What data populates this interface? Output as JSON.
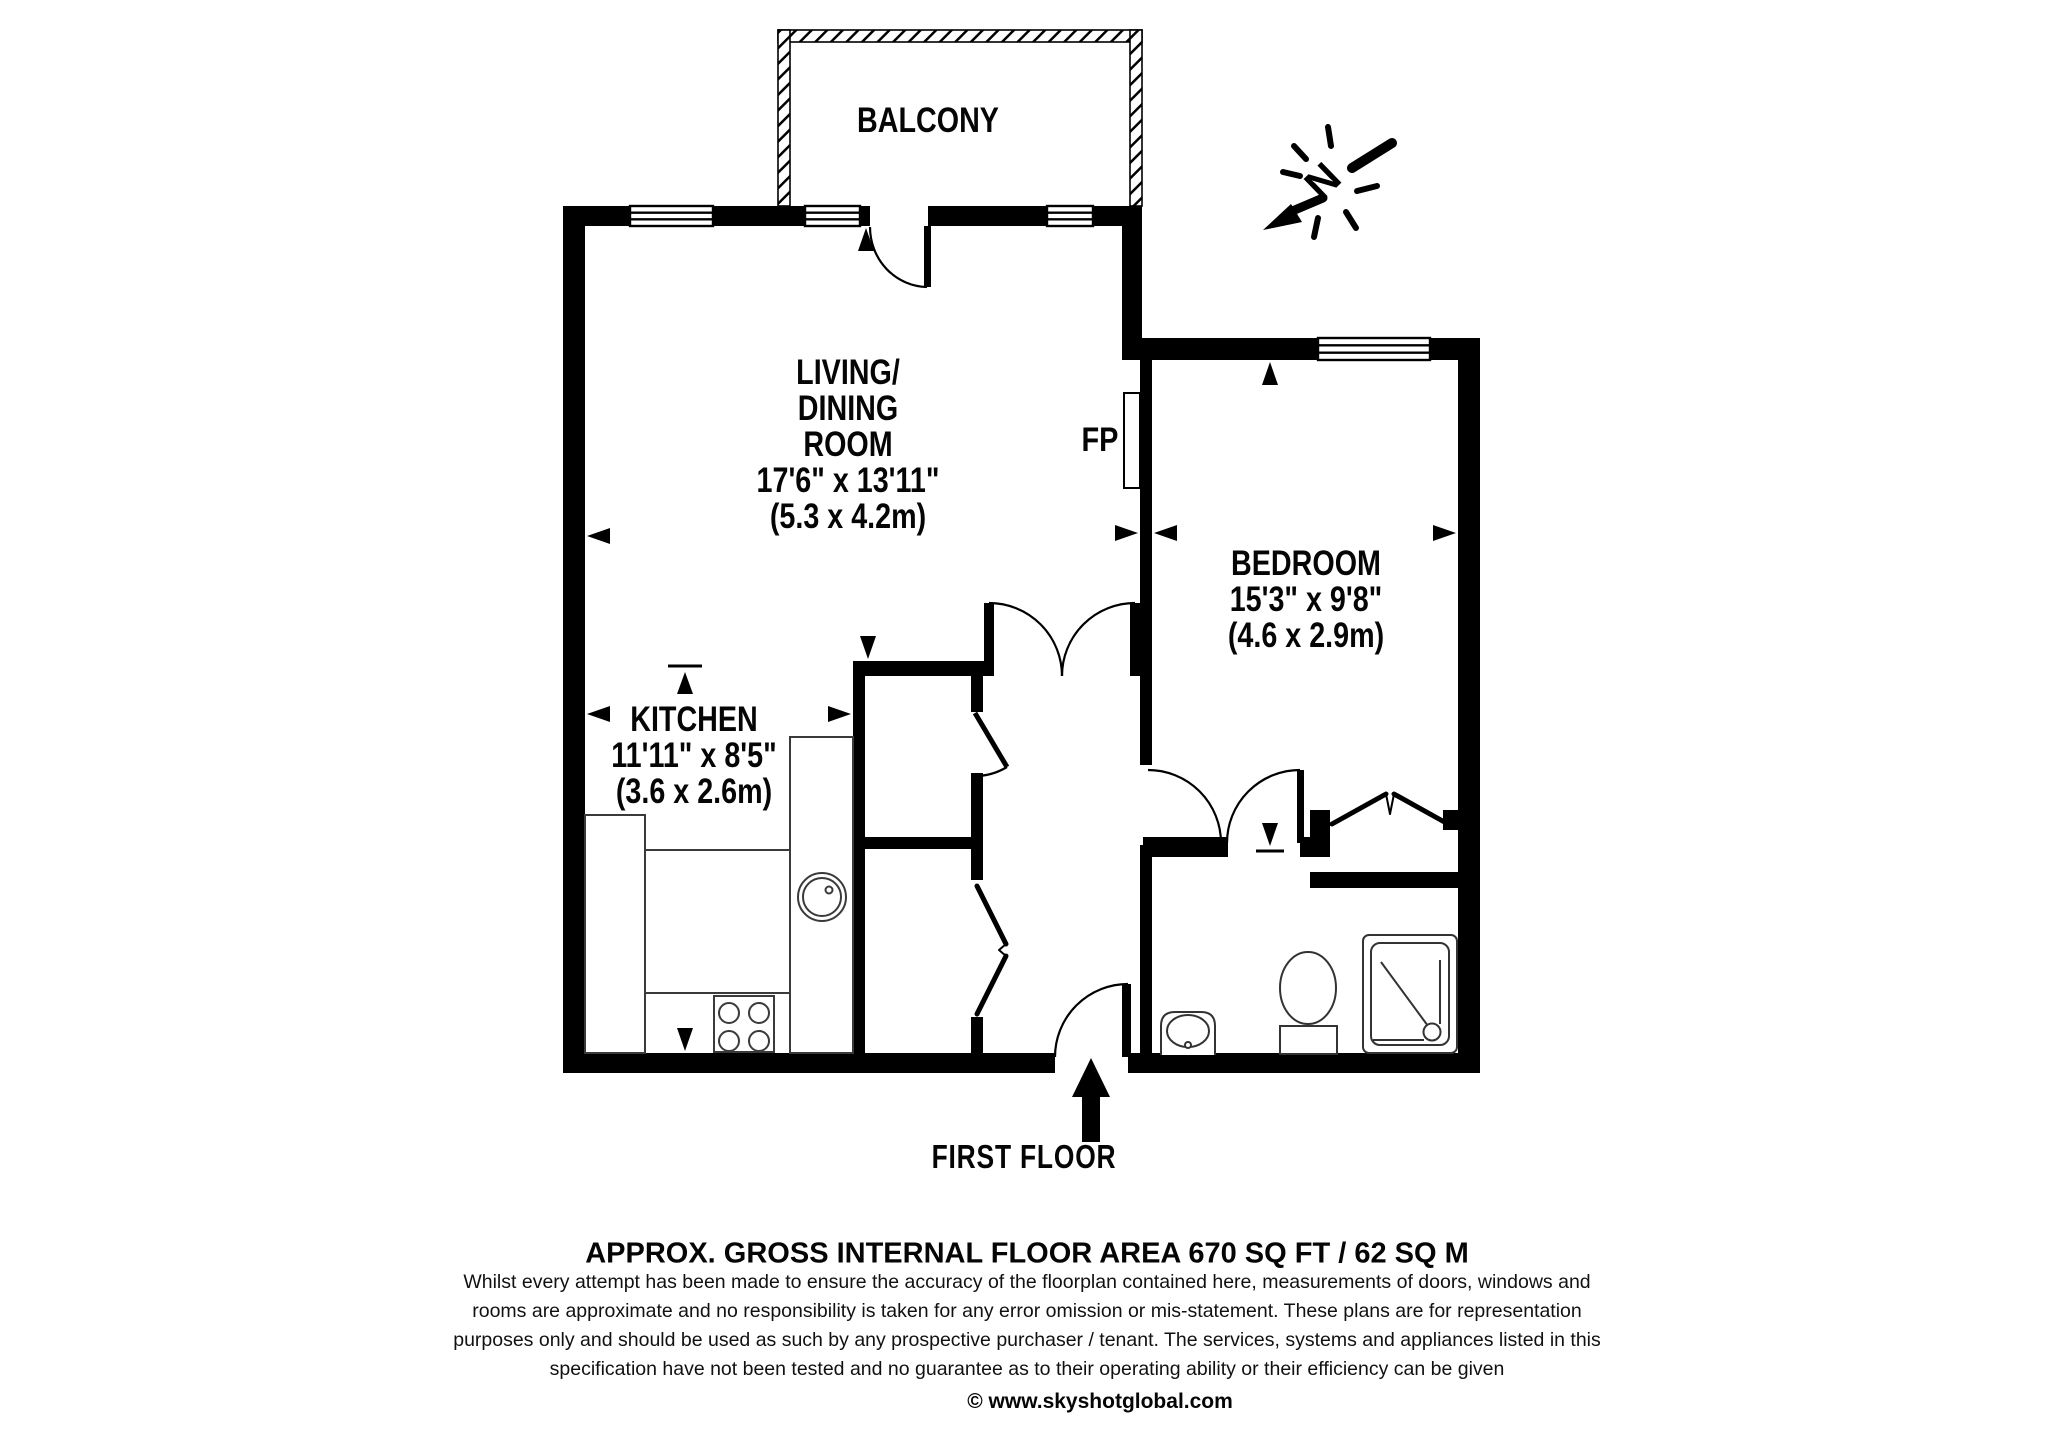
{
  "page": {
    "background": "#ffffff",
    "line_color": "#000000"
  },
  "plan": {
    "floor_label": "FIRST FLOOR",
    "area_label": "APPROX. GROSS INTERNAL FLOOR AREA 670 SQ FT / 62 SQ M",
    "compass_letter": "N"
  },
  "rooms": {
    "balcony": {
      "name": "BALCONY"
    },
    "living": {
      "line1": "LIVING/",
      "line2": "DINING",
      "line3": "ROOM",
      "imperial": "17'6\" x 13'11\"",
      "metric": "(5.3 x 4.2m)"
    },
    "bedroom": {
      "name": "BEDROOM",
      "imperial": "15'3\" x 9'8\"",
      "metric": "(4.6 x 2.9m)"
    },
    "kitchen": {
      "name": "KITCHEN",
      "imperial": "11'11\" x 8'5\"",
      "metric": "(3.6 x 2.6m)"
    },
    "fireplace": {
      "label": "FP"
    }
  },
  "footer": {
    "disclaimer_lines": [
      "Whilst every attempt has been made to ensure the accuracy of the floorplan contained here, measurements of doors, windows and",
      "rooms are approximate and no responsibility is taken for any error omission or mis-statement. These plans are for representation",
      "purposes only and should  be used as such by any prospective purchaser / tenant. The services, systems and appliances listed in this",
      "specification have not been tested and no guarantee as to their operating ability or their efficiency can be given"
    ],
    "copyright": "© www.skyshotglobal.com"
  }
}
